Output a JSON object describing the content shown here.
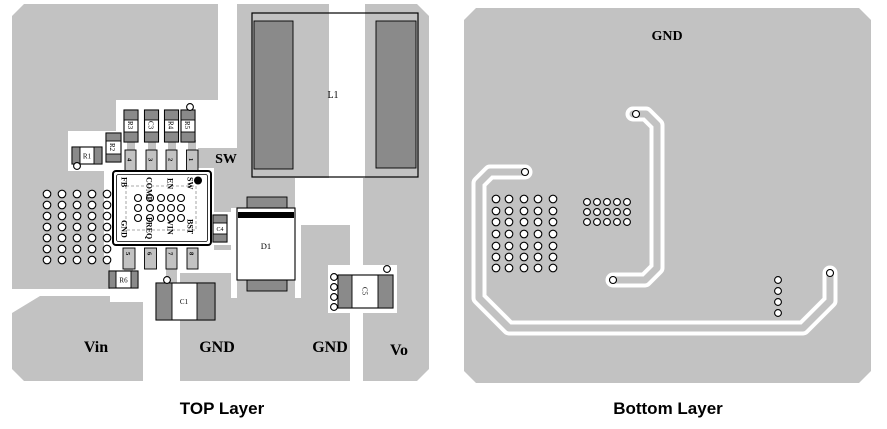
{
  "figure": {
    "top": {
      "caption": "TOP Layer",
      "net_labels": {
        "sw": "SW",
        "vin": "Vin",
        "gnd_input": "GND",
        "gnd_output": "GND",
        "vo": "Vo"
      },
      "components": {
        "r1": "R1",
        "r2": "R2",
        "r3": "R3",
        "c3": "C3",
        "r4": "R4",
        "r5": "R5",
        "r6": "R6",
        "c1": "C1",
        "c4": "C4",
        "c5": "C5",
        "d1": "D1",
        "l1": "L1"
      },
      "ic": {
        "pins_top": [
          "FB",
          "COMP",
          "EN",
          "SW"
        ],
        "pins_bottom": [
          "GND",
          "FREQ",
          "VIN",
          "BST"
        ],
        "pads_top": [
          "4",
          "3",
          "2",
          "1"
        ],
        "pads_bottom": [
          "5",
          "6",
          "7",
          "8"
        ]
      }
    },
    "bottom": {
      "caption": "Bottom Layer",
      "net_labels": {
        "gnd": "GND"
      }
    },
    "colors": {
      "plane": "#c2c2c2",
      "pad": "#8a8a8a",
      "clearance": "#ffffff",
      "outline": "#000000",
      "background": "#ffffff"
    }
  }
}
